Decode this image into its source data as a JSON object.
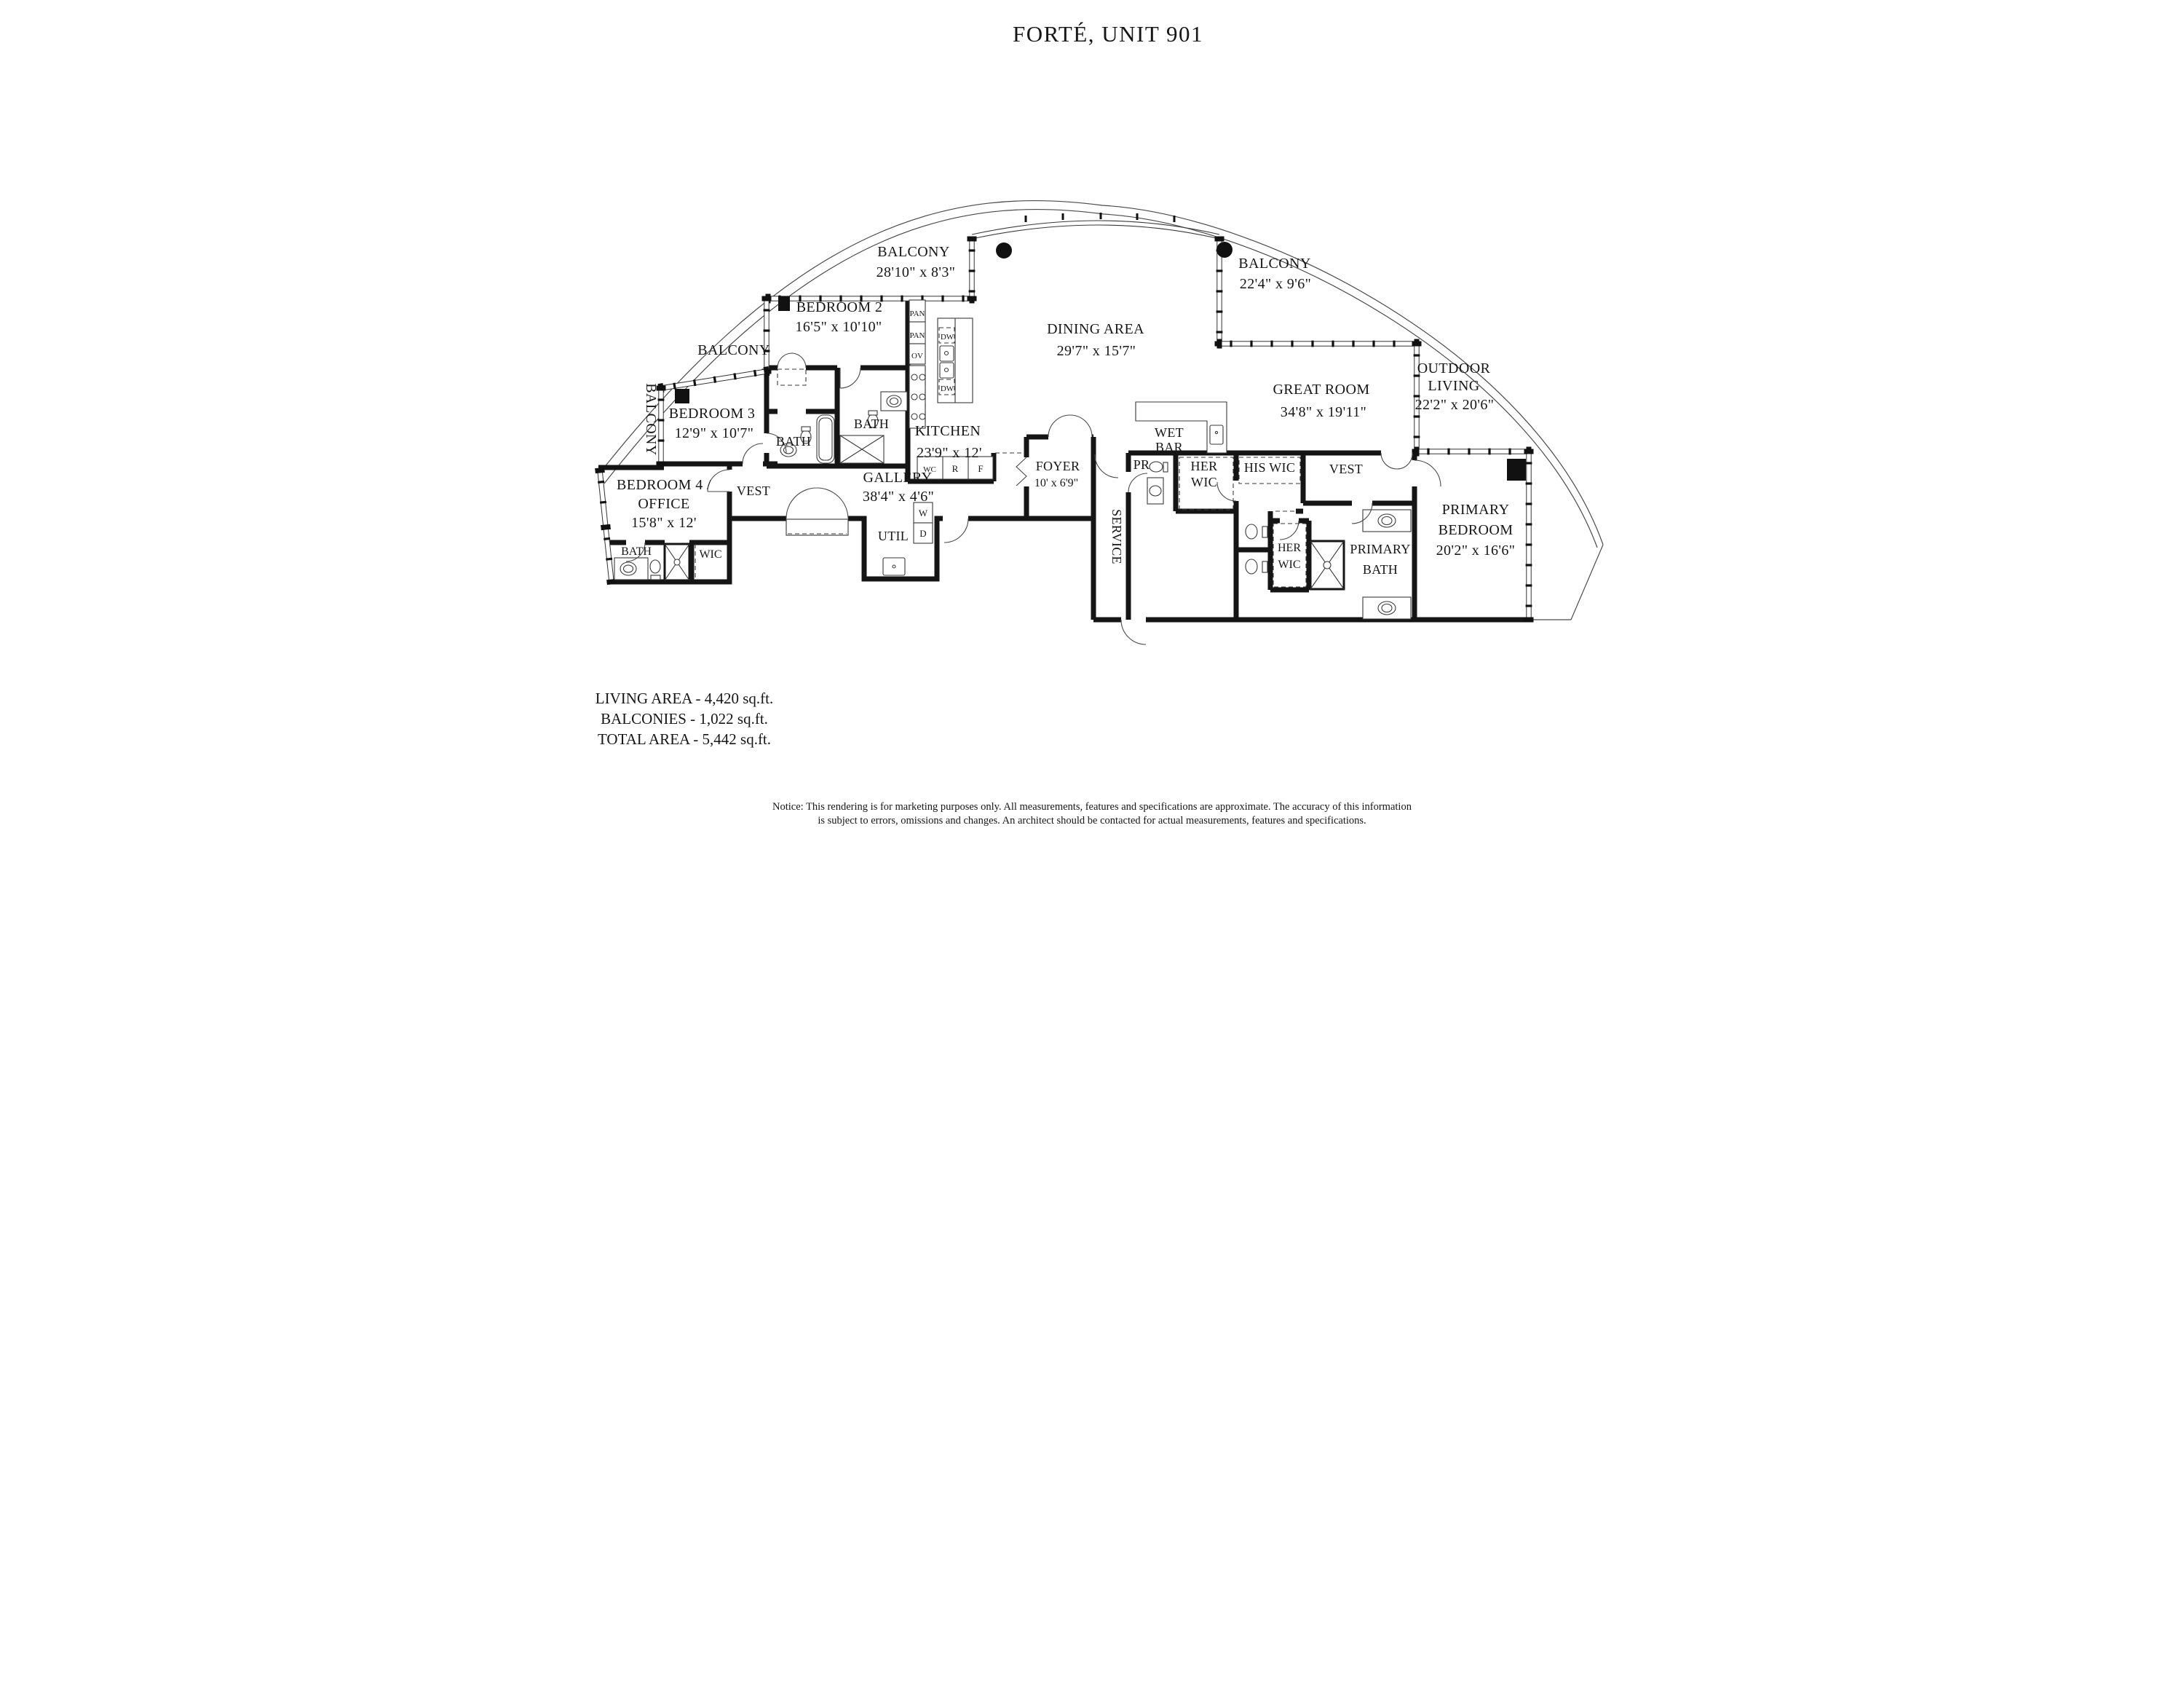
{
  "title": "FORTÉ, UNIT 901",
  "rooms": {
    "balcony_top_left": {
      "name": "BALCONY",
      "dims": "28'10\" x 8'3\""
    },
    "balcony_top_right": {
      "name": "BALCONY",
      "dims": "22'4\" x 9'6\""
    },
    "balcony_left": {
      "name": "BALCONY"
    },
    "balcony_side": {
      "name": "BALCONY"
    },
    "bedroom2": {
      "name": "BEDROOM 2",
      "dims": "16'5\" x 10'10\""
    },
    "bedroom3": {
      "name": "BEDROOM 3",
      "dims": "12'9\" x 10'7\""
    },
    "bedroom4": {
      "line1": "BEDROOM 4 /",
      "line2": "OFFICE",
      "dims": "15'8\" x 12'"
    },
    "bath2": {
      "name": "BATH"
    },
    "bath3": {
      "name": "BATH"
    },
    "bath4": {
      "name": "BATH"
    },
    "wic4": {
      "name": "WIC"
    },
    "vest_left": {
      "name": "VEST"
    },
    "vest_right": {
      "name": "VEST"
    },
    "gallery": {
      "name": "GALLERY",
      "dims": "38'4\" x 4'6\""
    },
    "util": {
      "name": "UTIL"
    },
    "kitchen": {
      "name": "KITCHEN",
      "dims": "23'9\" x 12'"
    },
    "dining": {
      "name": "DINING AREA",
      "dims": "29'7\" x 15'7\""
    },
    "great_room": {
      "name": "GREAT ROOM",
      "dims": "34'8\" x 19'11\""
    },
    "outdoor_living": {
      "line1": "OUTDOOR",
      "line2": "LIVING",
      "dims": "22'2\" x 20'6\""
    },
    "foyer": {
      "name": "FOYER",
      "dims": "10' x 6'9\""
    },
    "service": {
      "name": "SERVICE"
    },
    "pr": {
      "name": "PR"
    },
    "wet_bar": {
      "line1": "WET",
      "line2": "BAR"
    },
    "her_wic": {
      "line1": "HER",
      "line2": "WIC"
    },
    "his_wic": {
      "name": "HIS WIC"
    },
    "her_wic2": {
      "line1": "HER",
      "line2": "WIC"
    },
    "primary_bath": {
      "line1": "PRIMARY",
      "line2": "BATH"
    },
    "primary_bedroom": {
      "line1": "PRIMARY",
      "line2": "BEDROOM",
      "dims": "20'2\" x 16'6\""
    }
  },
  "appliances": {
    "pan1": "PAN",
    "pan2": "PAN",
    "oven": "OV",
    "dw1": "DW",
    "dw2": "DW",
    "wc": "WC",
    "refrigerator": "R",
    "freezer": "F",
    "washer": "W",
    "dryer": "D"
  },
  "stats": {
    "living": "LIVING AREA - 4,420 sq.ft.",
    "balconies": "BALCONIES - 1,022 sq.ft.",
    "total": "TOTAL AREA - 5,442 sq.ft."
  },
  "notice": {
    "line1": "Notice: This rendering is for marketing purposes only. All measurements, features and specifications are approximate. The accuracy of this information",
    "line2": "is subject to errors, omissions and changes. An architect should be contacted for actual measurements, features and specifications."
  },
  "colors": {
    "ink": "#161616",
    "background": "#ffffff"
  }
}
